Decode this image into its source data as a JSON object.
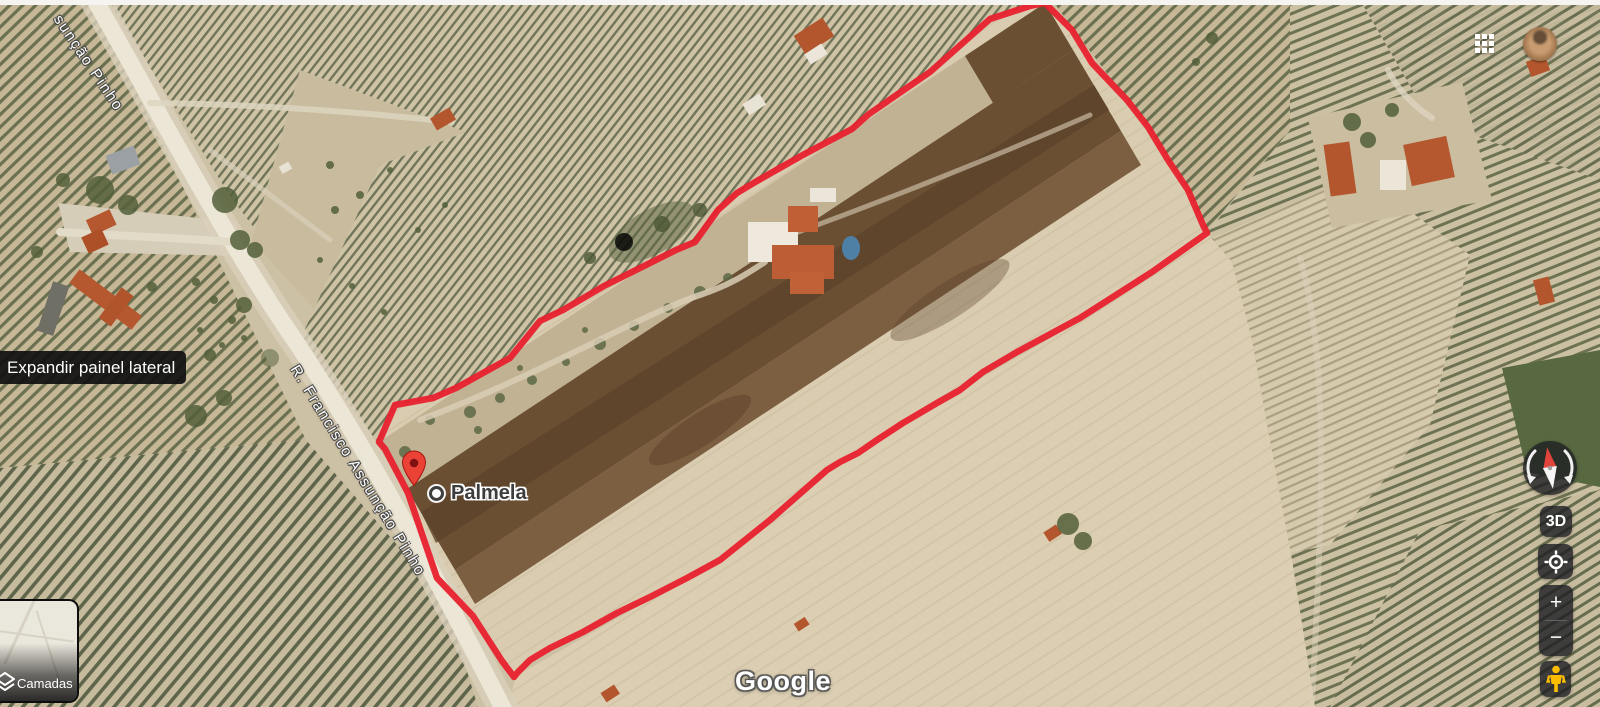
{
  "map": {
    "attribution": "Google",
    "place": {
      "name": "Palmela"
    },
    "streets": {
      "full": "R. Francisco Assunção Pinho",
      "partial": "sunção Pinho"
    },
    "property_outline_points": "1045,3 1072,30 1092,63 1127,100 1148,127 1168,160 1188,190 1203,225 1207,233 1152,272 1080,318 1017,352 983,372 960,390 937,403 903,423 877,440 858,453 840,462 827,470 770,520 720,560 687,578 650,597 617,613 583,632 550,648 530,660 518,672 514,677 502,661 473,616 437,578 408,493 385,449 379,442 395,405 433,398 456,388 510,358 540,321 563,310 604,286 644,266 676,250 695,242 718,210 737,193 757,181 801,156 831,140 852,129 869,114 930,72 990,19 1030,6",
    "colors": {
      "outline_red": "#e8212e",
      "pin_red": "#EA4335",
      "pin_dot": "#7f1113"
    }
  },
  "tooltip": {
    "text": "Expandir painel lateral"
  },
  "layers_button": {
    "label": "Camadas",
    "icon": "layers-stack"
  },
  "controls": {
    "compass_icon": "compass-needle",
    "tilt_label": "3D",
    "my_location_icon": "crosshair-target",
    "zoom_in": "+",
    "zoom_out": "−",
    "pegman_icon": "street-view-pegman",
    "pegman_color": "#fbbc04",
    "control_bg": "rgba(32,33,36,0.82)"
  },
  "topbar": {
    "apps_icon": "google-apps-grid",
    "avatar": "account-avatar"
  }
}
